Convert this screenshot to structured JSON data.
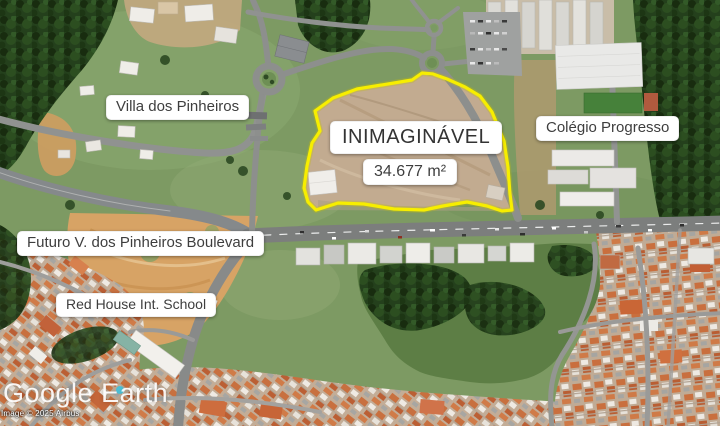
{
  "map": {
    "labels": {
      "villa": "Villa dos Pinheiros",
      "colegio": "Colégio Progresso",
      "boulevard": "Futuro V. dos Pinheiros Boulevard",
      "school": "Red House Int. School"
    },
    "lot": {
      "name": "INIMAGINÁVEL",
      "area": "34.677 m²",
      "outline_color": "#f7ee00"
    }
  },
  "watermark": {
    "logo": "Google Earth",
    "attribution": "Image © 2025 Airbus"
  },
  "colors": {
    "grass": "#7d9a63",
    "forest": "#24401c",
    "dirt_lot": "#c2ab90",
    "dirt_orange": "#d7a365",
    "road": "#8d8f8d",
    "roof": "#c8703f",
    "label_bg": "#ffffff",
    "label_text": "#3e3e3e"
  }
}
